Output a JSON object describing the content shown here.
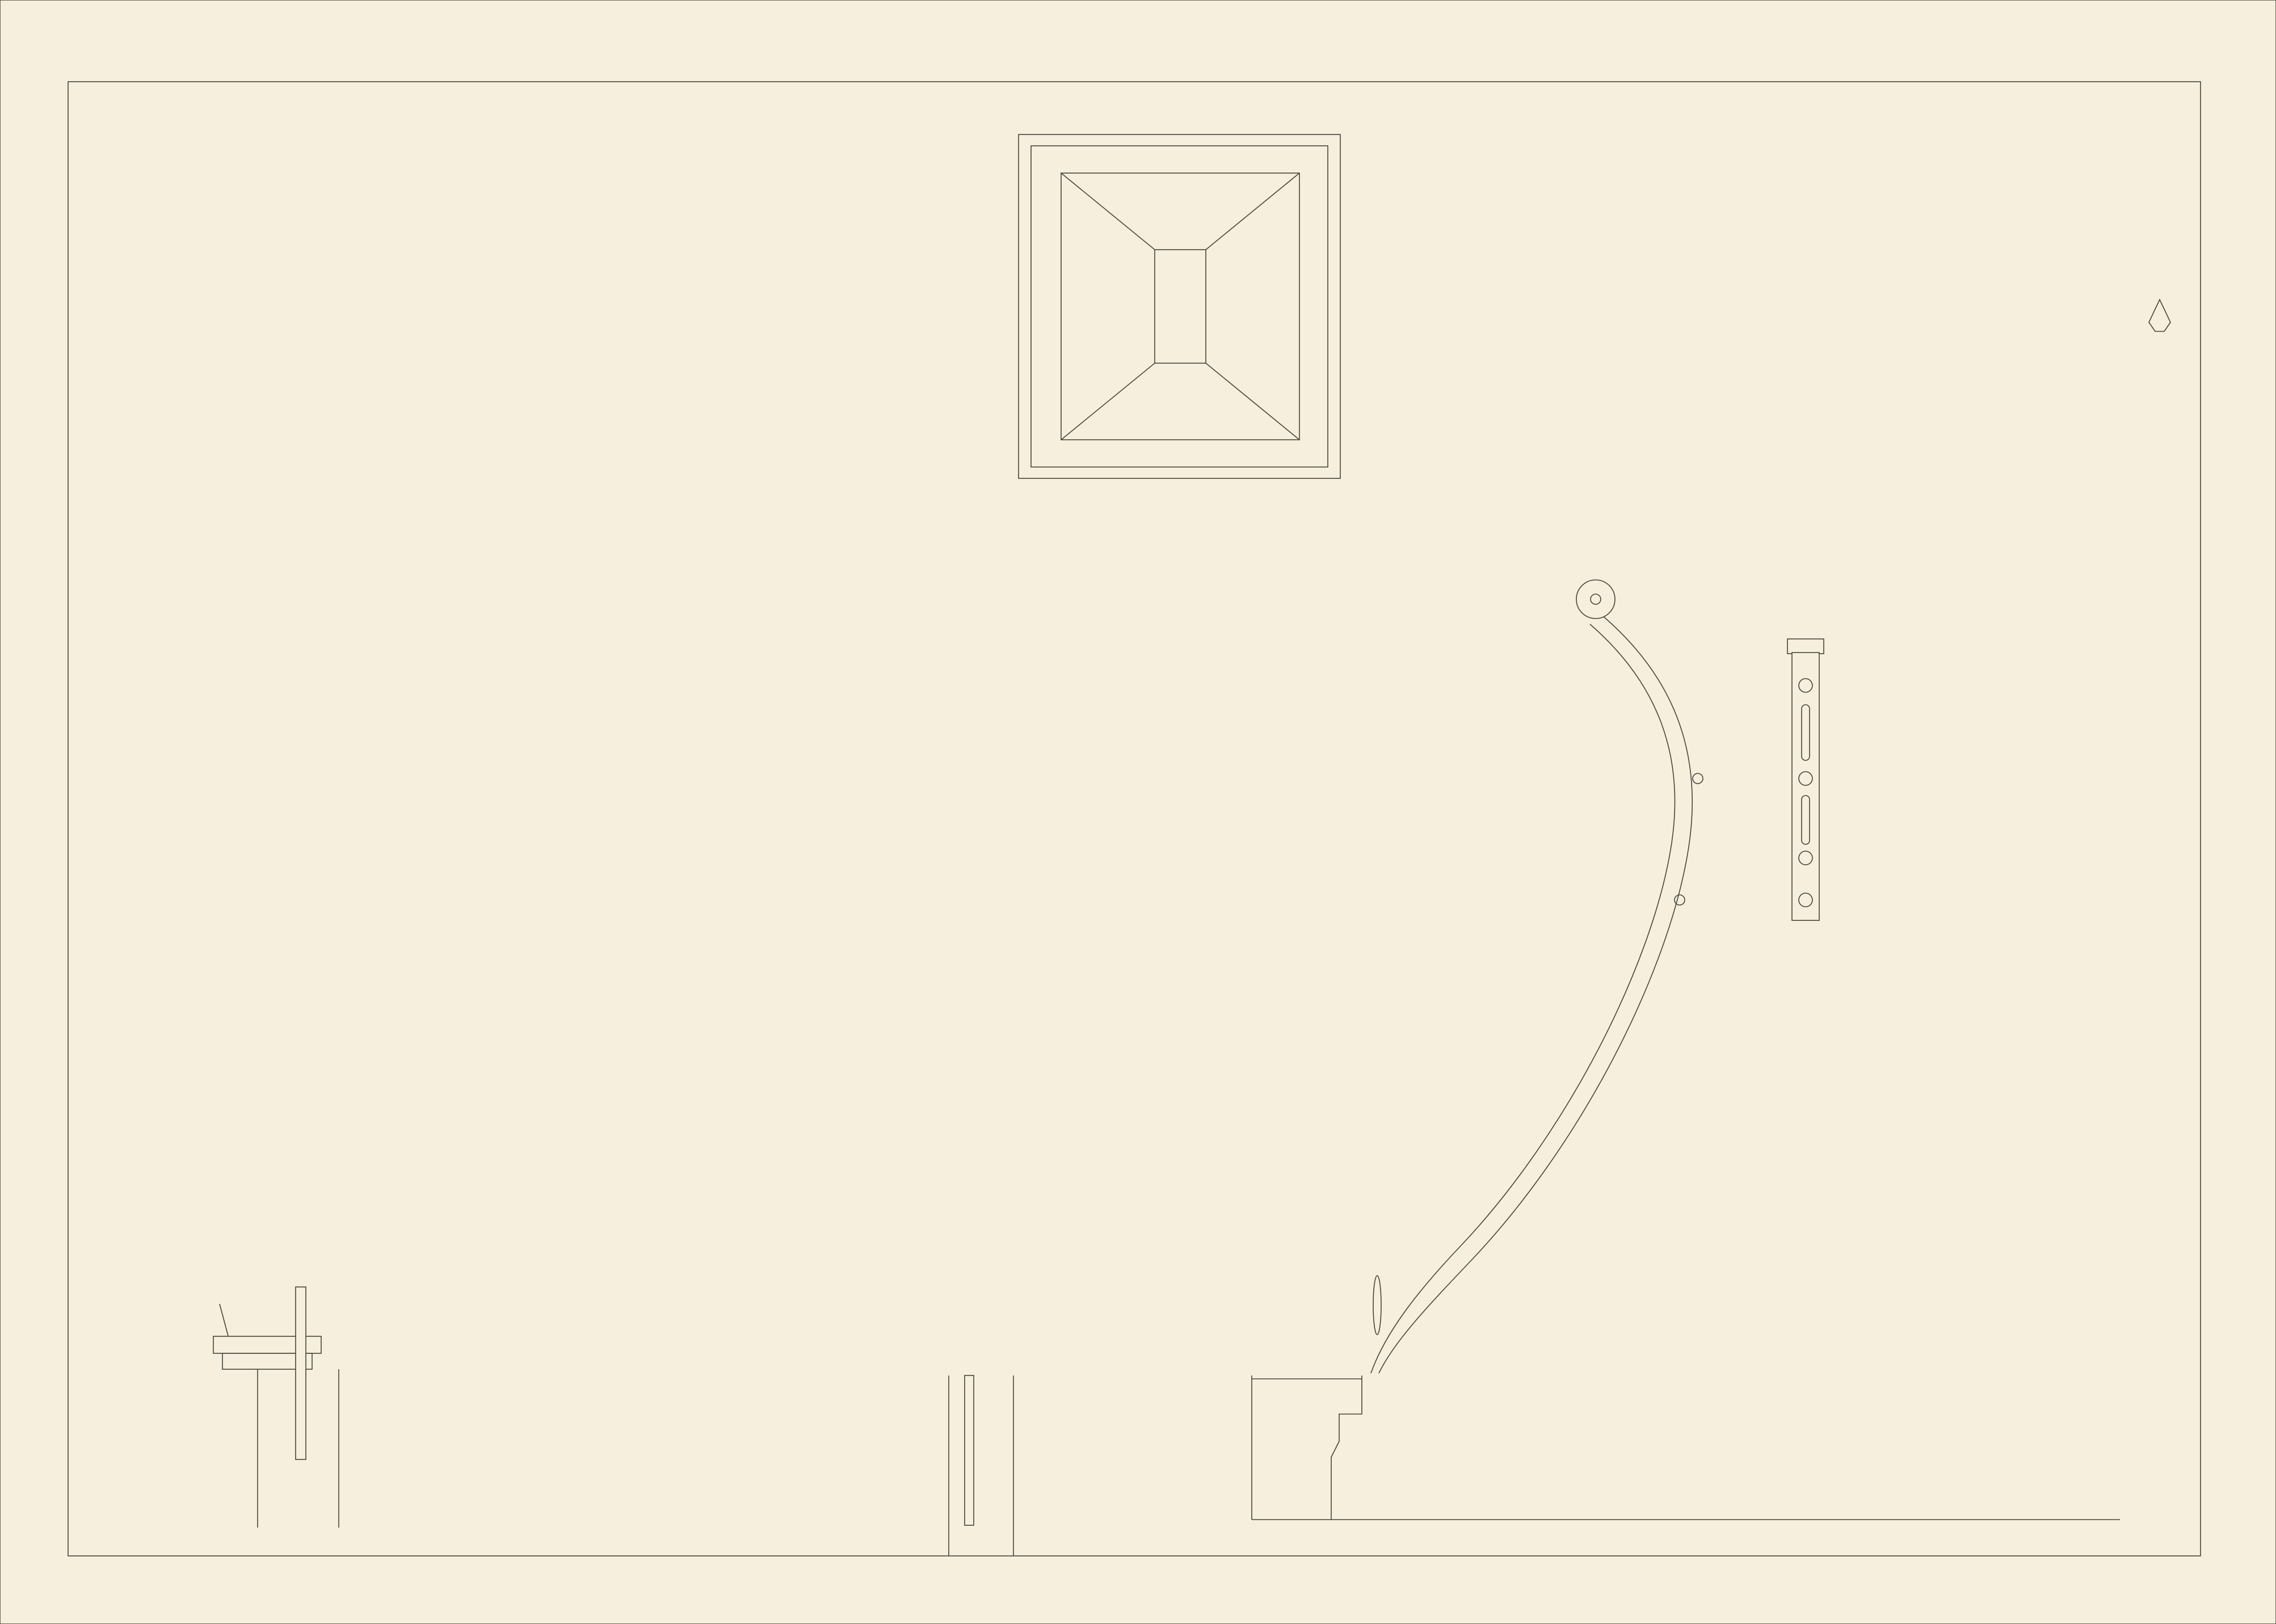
{
  "plate": {
    "number": "Pl. 47."
  },
  "labels": {
    "roof_plan": "Plan Général du Comble.",
    "grillage": "Plan des Grillages en Fer .",
    "floor_section": "Coupe du Plancher  A",
    "floor_detail_line1": "Détail du Plan",
    "floor_detail_line2": "d'un Plancher  A",
    "section_mark": "A"
  },
  "scales": {
    "ferme": {
      "title": "Echelles pour la Ferme du Comble.",
      "bars": [
        {
          "label": "10 Pieds"
        },
        {
          "label": "3 Mètres"
        }
      ]
    },
    "planchers": {
      "title": "Echelles des Détails des Planchers .",
      "bars": [
        {
          "label": "2 Mètres"
        },
        {
          "label": "6 Pieds"
        }
      ]
    }
  },
  "title": {
    "main": "Moitié de l'une des Fermes du Comble de la Bourse."
  },
  "colors": {
    "paper": "#f6efde",
    "ink": "#45453a",
    "foxing": "#c09a6d"
  }
}
